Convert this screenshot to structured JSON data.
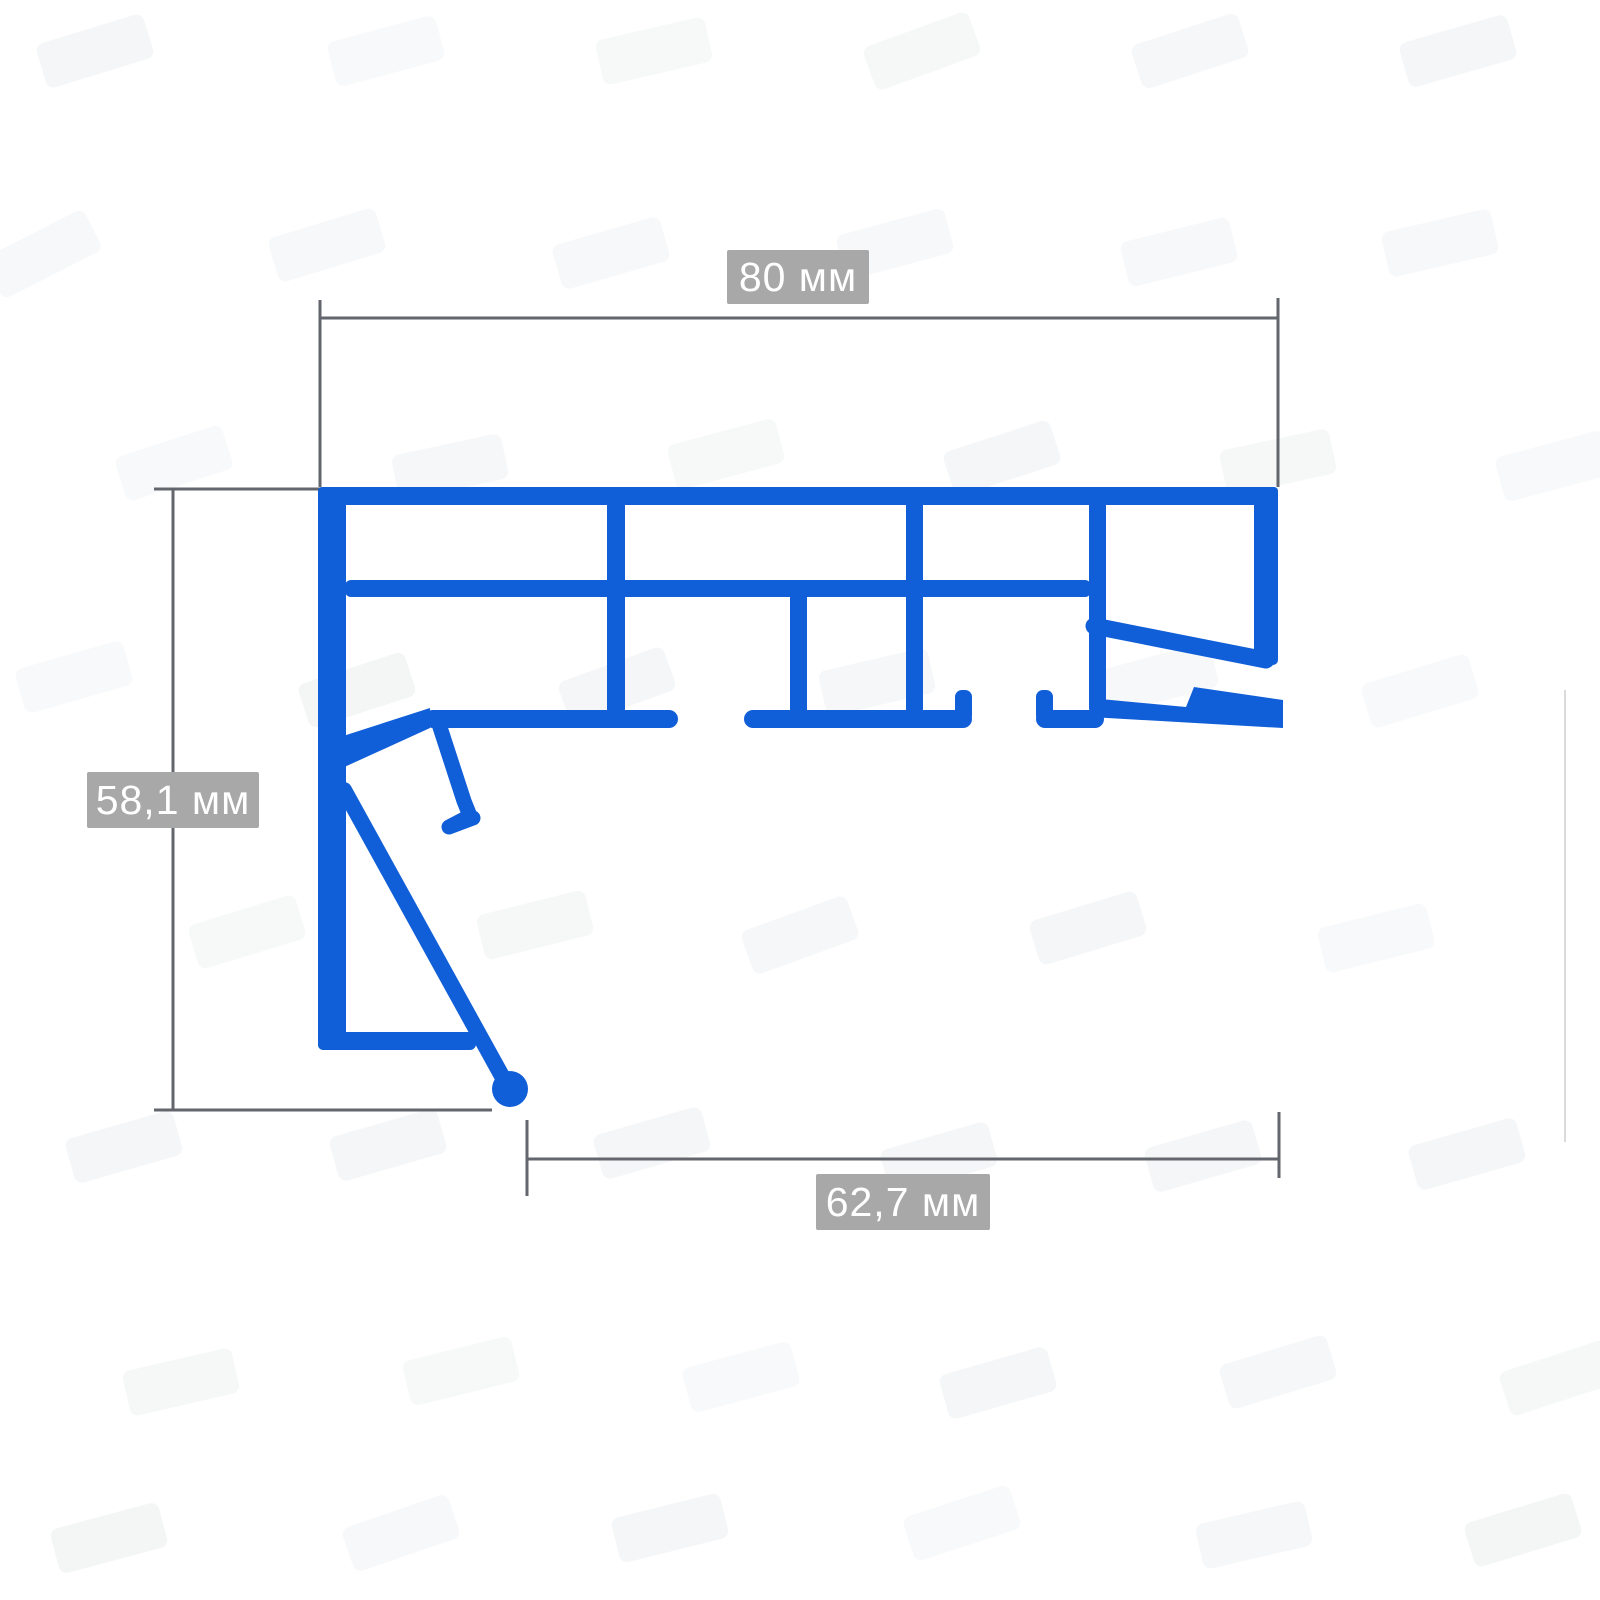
{
  "diagram": {
    "kind": "profile-cross-section-drawing",
    "dimensions": {
      "top_width": {
        "value": "80 мм"
      },
      "left_height": {
        "value": "58,1 мм"
      },
      "bottom_width": {
        "value": "62,7 мм"
      }
    },
    "colors": {
      "profile": "#115fd8",
      "dimension_lines": "#63666c",
      "label_background": "#a8a8a8",
      "label_text": "#ffffff"
    }
  }
}
